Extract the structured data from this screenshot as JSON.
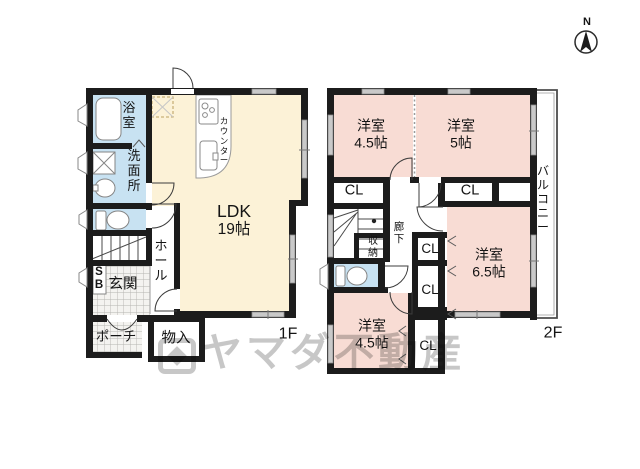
{
  "compass": {
    "north_label": "N"
  },
  "watermark": {
    "text": "ヤマダ不動産"
  },
  "colors": {
    "room_cream": "#fcf2d7",
    "room_pink": "#f8dcd4",
    "room_blue": "#c8e2f2",
    "wall": "#1c1c1c",
    "window_gray": "#c9c9c9"
  },
  "floor1": {
    "label": "1F",
    "ldk": {
      "name": "LDK",
      "size": "19帖"
    },
    "kitchen_counter": "カウンター",
    "bath": "浴室",
    "washroom": "洗面所",
    "hall": "ホール",
    "shoe_box": "SB",
    "entrance": "玄関",
    "porch": "ポーチ",
    "storage": "物入"
  },
  "floor2": {
    "label": "2F",
    "room_top_left": {
      "name": "洋室",
      "size": "4.5帖"
    },
    "room_top_right": {
      "name": "洋室",
      "size": "5帖"
    },
    "room_right": {
      "name": "洋室",
      "size": "6.5帖"
    },
    "room_bottom_left": {
      "name": "洋室",
      "size": "4.5帖"
    },
    "closet_top_left": "CL",
    "closet_top_right": "CL",
    "closet_mid_upper": "CL",
    "closet_mid_lower": "CL",
    "closet_bottom": "CL",
    "hallway": "廊下",
    "storage": "収納",
    "balcony": "バルコニー"
  }
}
